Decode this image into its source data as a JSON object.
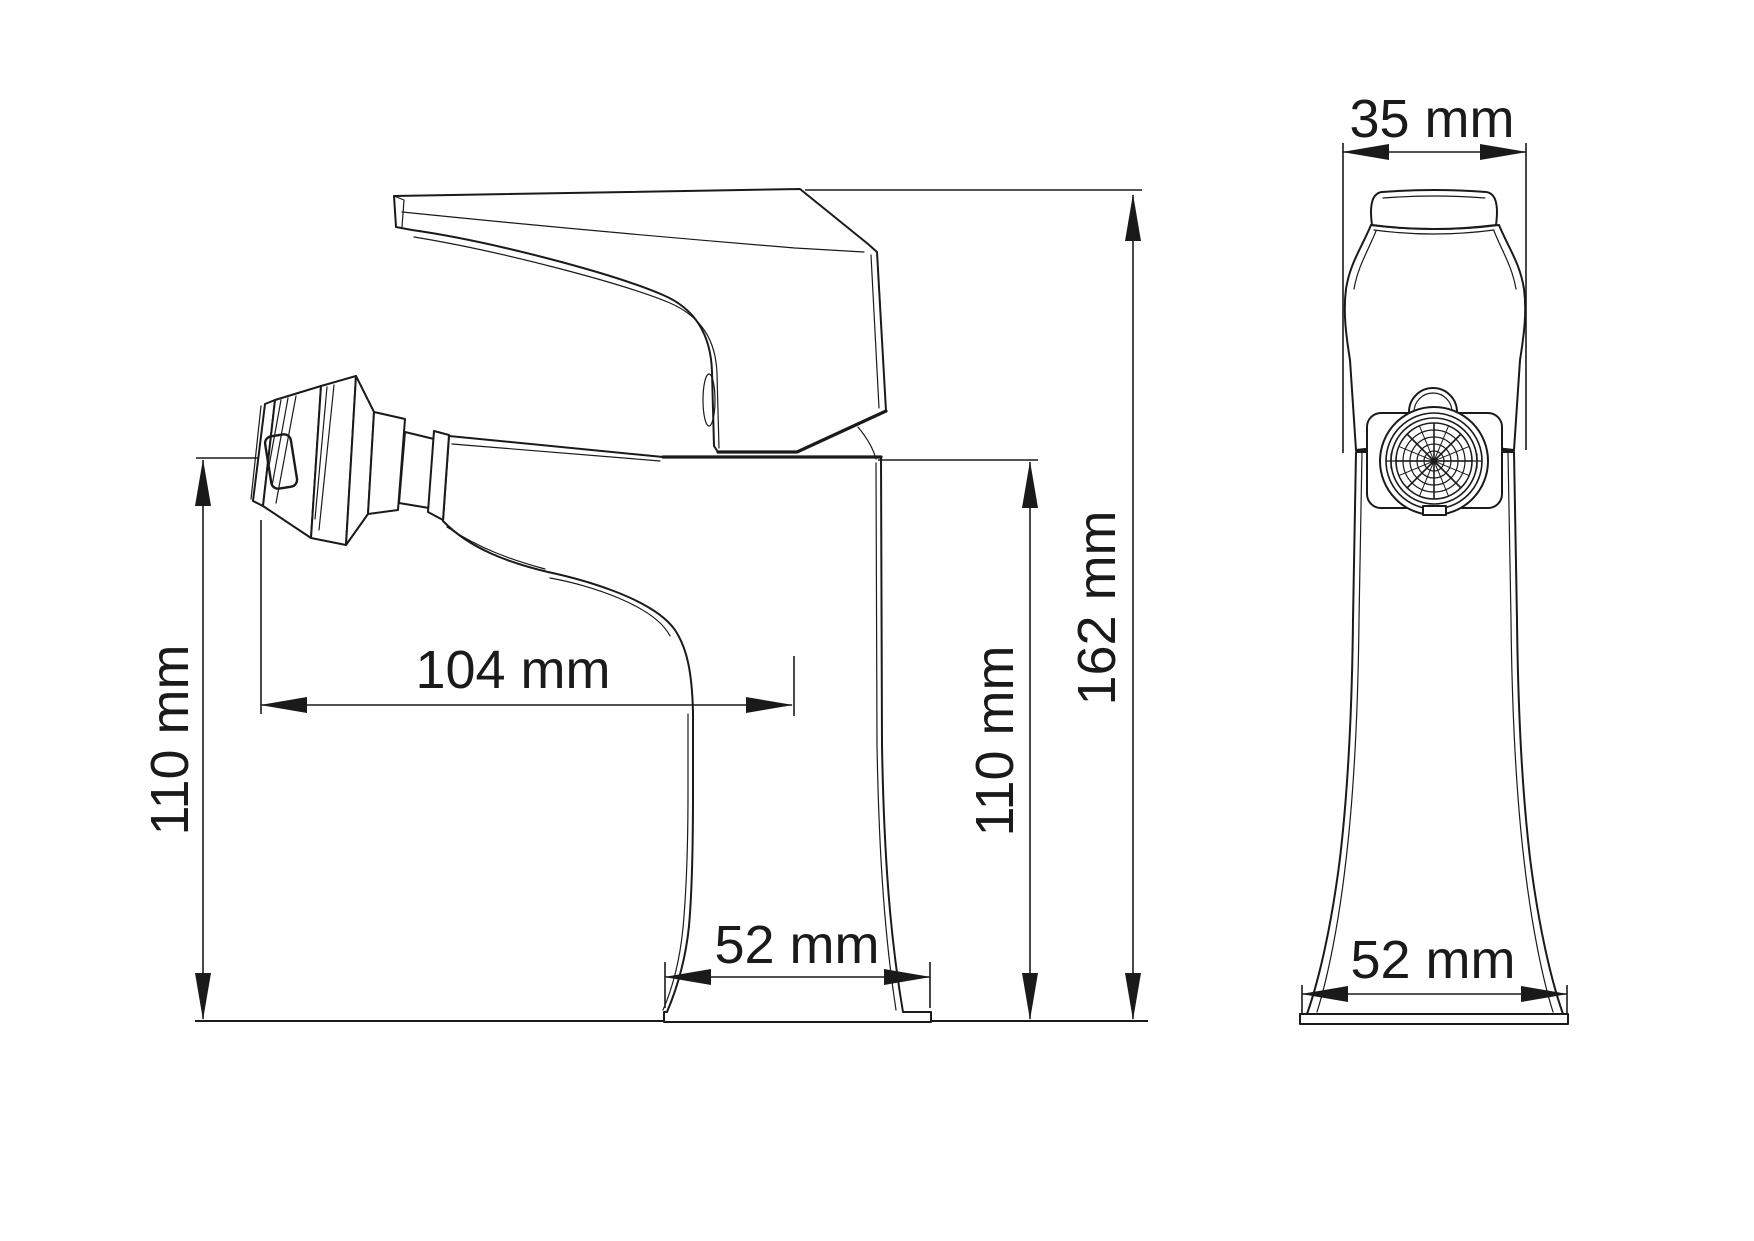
{
  "document": {
    "kind": "technical-dimension-drawing",
    "subject": "single-lever basin / bidet faucet, two orthographic views (side view and front view)",
    "background_color": "#ffffff",
    "line_color": "#1a1a1a"
  },
  "dimensions": {
    "side_view": {
      "spout_height_left": {
        "label": "110 mm",
        "value": 110,
        "unit": "mm",
        "orientation": "vertical"
      },
      "spout_reach": {
        "label": "104 mm",
        "value": 104,
        "unit": "mm",
        "orientation": "horizontal"
      },
      "body_height_right": {
        "label": "110 mm",
        "value": 110,
        "unit": "mm",
        "orientation": "vertical"
      },
      "total_height": {
        "label": "162 mm",
        "value": 162,
        "unit": "mm",
        "orientation": "vertical"
      },
      "base_width": {
        "label": "52 mm",
        "value": 52,
        "unit": "mm",
        "orientation": "horizontal"
      }
    },
    "front_view": {
      "handle_width": {
        "label": "35 mm",
        "value": 35,
        "unit": "mm",
        "orientation": "horizontal"
      },
      "base_width": {
        "label": "52 mm",
        "value": 52,
        "unit": "mm",
        "orientation": "horizontal"
      }
    }
  }
}
